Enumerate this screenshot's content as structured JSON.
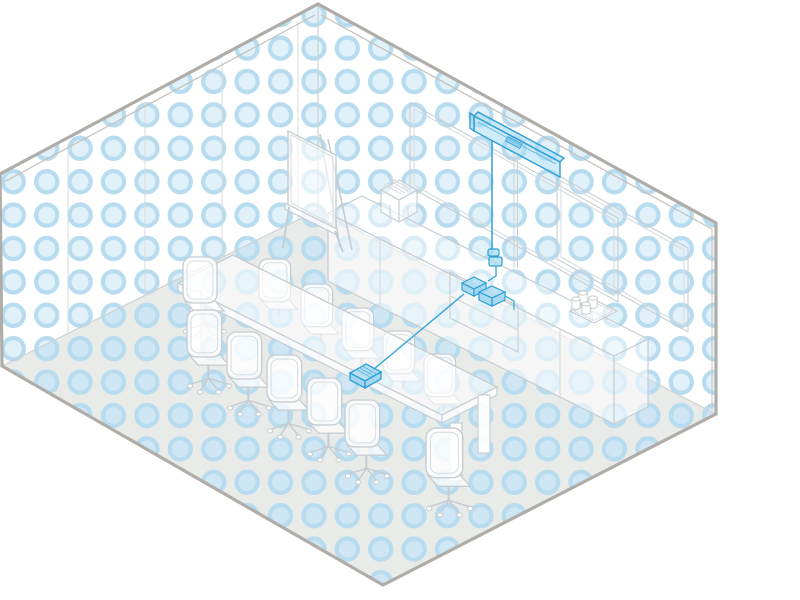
{
  "title": "Isometric illustration of a large meeting room with highlighted video conferencing equipment",
  "palette": {
    "background": "#ffffff",
    "wall_fill": "#ffffff",
    "floor_fill": "#e9ebe8",
    "outer_edge": "#b0ada9",
    "inner_edge": "#c3c0bb",
    "junction_line": "#ccd1d3",
    "seam_line": "#d8dcde",
    "furniture_outline": "#c6ccd1",
    "furniture_detail": "#d8dde0",
    "dot_ring": "#b8dcef",
    "dot_center": "#e1f1fa",
    "floor_dot": "#b7d9ec",
    "highlight_stroke": "#35a1d8",
    "highlight_fill": "#aadcf2",
    "cable": "#3fa8db"
  },
  "scene": {
    "room": {
      "type": "isometric-corner-room",
      "wall_pattern": "blue-dot-grid",
      "floor_pattern": "blue-dot-grid-muted",
      "left_wall_panel_seams": 4
    },
    "highlighted_equipment": [
      {
        "name": "video-bar",
        "location": "right wall, above display outline"
      },
      {
        "name": "drop-cable",
        "location": "right wall, from video bar to cable clip"
      },
      {
        "name": "cable-clip",
        "location": "right wall above credenza shelf"
      },
      {
        "name": "av-box",
        "count": 2,
        "location": "credenza open shelf"
      },
      {
        "name": "table-controller",
        "location": "conference table, right half"
      },
      {
        "name": "table-cable",
        "location": "from controller to credenza shelf"
      }
    ],
    "furniture": [
      {
        "name": "wall-display-outline",
        "location": "right wall"
      },
      {
        "name": "glass-board-outline",
        "location": "right wall, right of display"
      },
      {
        "name": "conference-table",
        "seats": 12
      },
      {
        "name": "office-chair",
        "count": 12
      },
      {
        "name": "credenza",
        "features": [
          "open shelf",
          "door seams"
        ]
      },
      {
        "name": "cup-tray",
        "cups": 4,
        "location": "credenza top, right end"
      },
      {
        "name": "slatted-box",
        "location": "credenza top, left end"
      },
      {
        "name": "flipchart-easel",
        "location": "against right wall, left of display"
      }
    ]
  }
}
